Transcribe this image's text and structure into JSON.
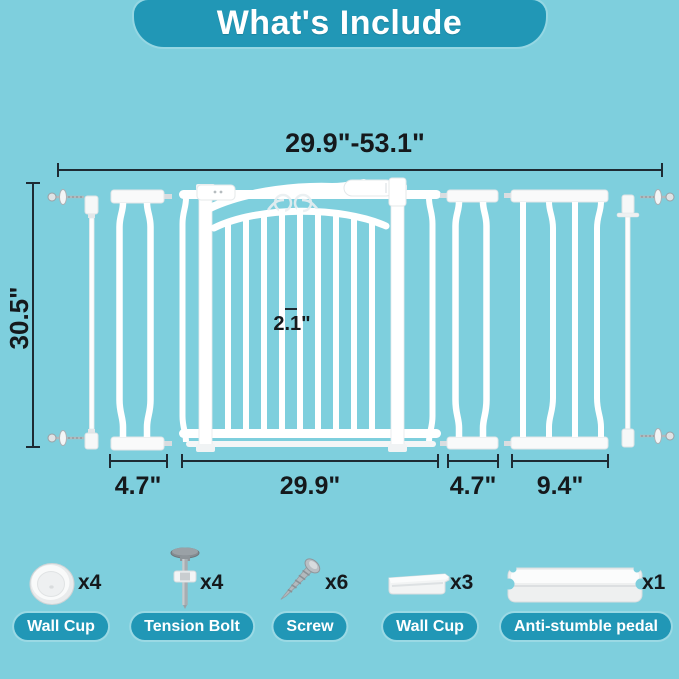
{
  "header": {
    "title": "What's Include"
  },
  "colors": {
    "background": "#7ecfdd",
    "accent_teal": "#2197b6",
    "dimension_line": "#1e2b33",
    "part_white": "#ffffff"
  },
  "dimensions": {
    "total_width_range": "29.9\"-53.1\"",
    "height": "30.5\"",
    "bar_gap": "2.1\"",
    "gate_width": "29.9\"",
    "left_extension_width": "4.7\"",
    "right_small_extension_width": "4.7\"",
    "right_large_extension_width": "9.4\""
  },
  "included_items": [
    {
      "name": "Wall Cup",
      "count": "x4",
      "icon": "wall-cup-round-icon"
    },
    {
      "name": "Tension Bolt",
      "count": "x4",
      "icon": "tension-bolt-icon"
    },
    {
      "name": "Screw",
      "count": "x6",
      "icon": "screw-icon"
    },
    {
      "name": "Wall Cup",
      "count": "x3",
      "icon": "wall-cup-bracket-icon"
    },
    {
      "name": "Anti-stumble pedal",
      "count": "x1",
      "icon": "anti-stumble-pedal-icon"
    }
  ]
}
